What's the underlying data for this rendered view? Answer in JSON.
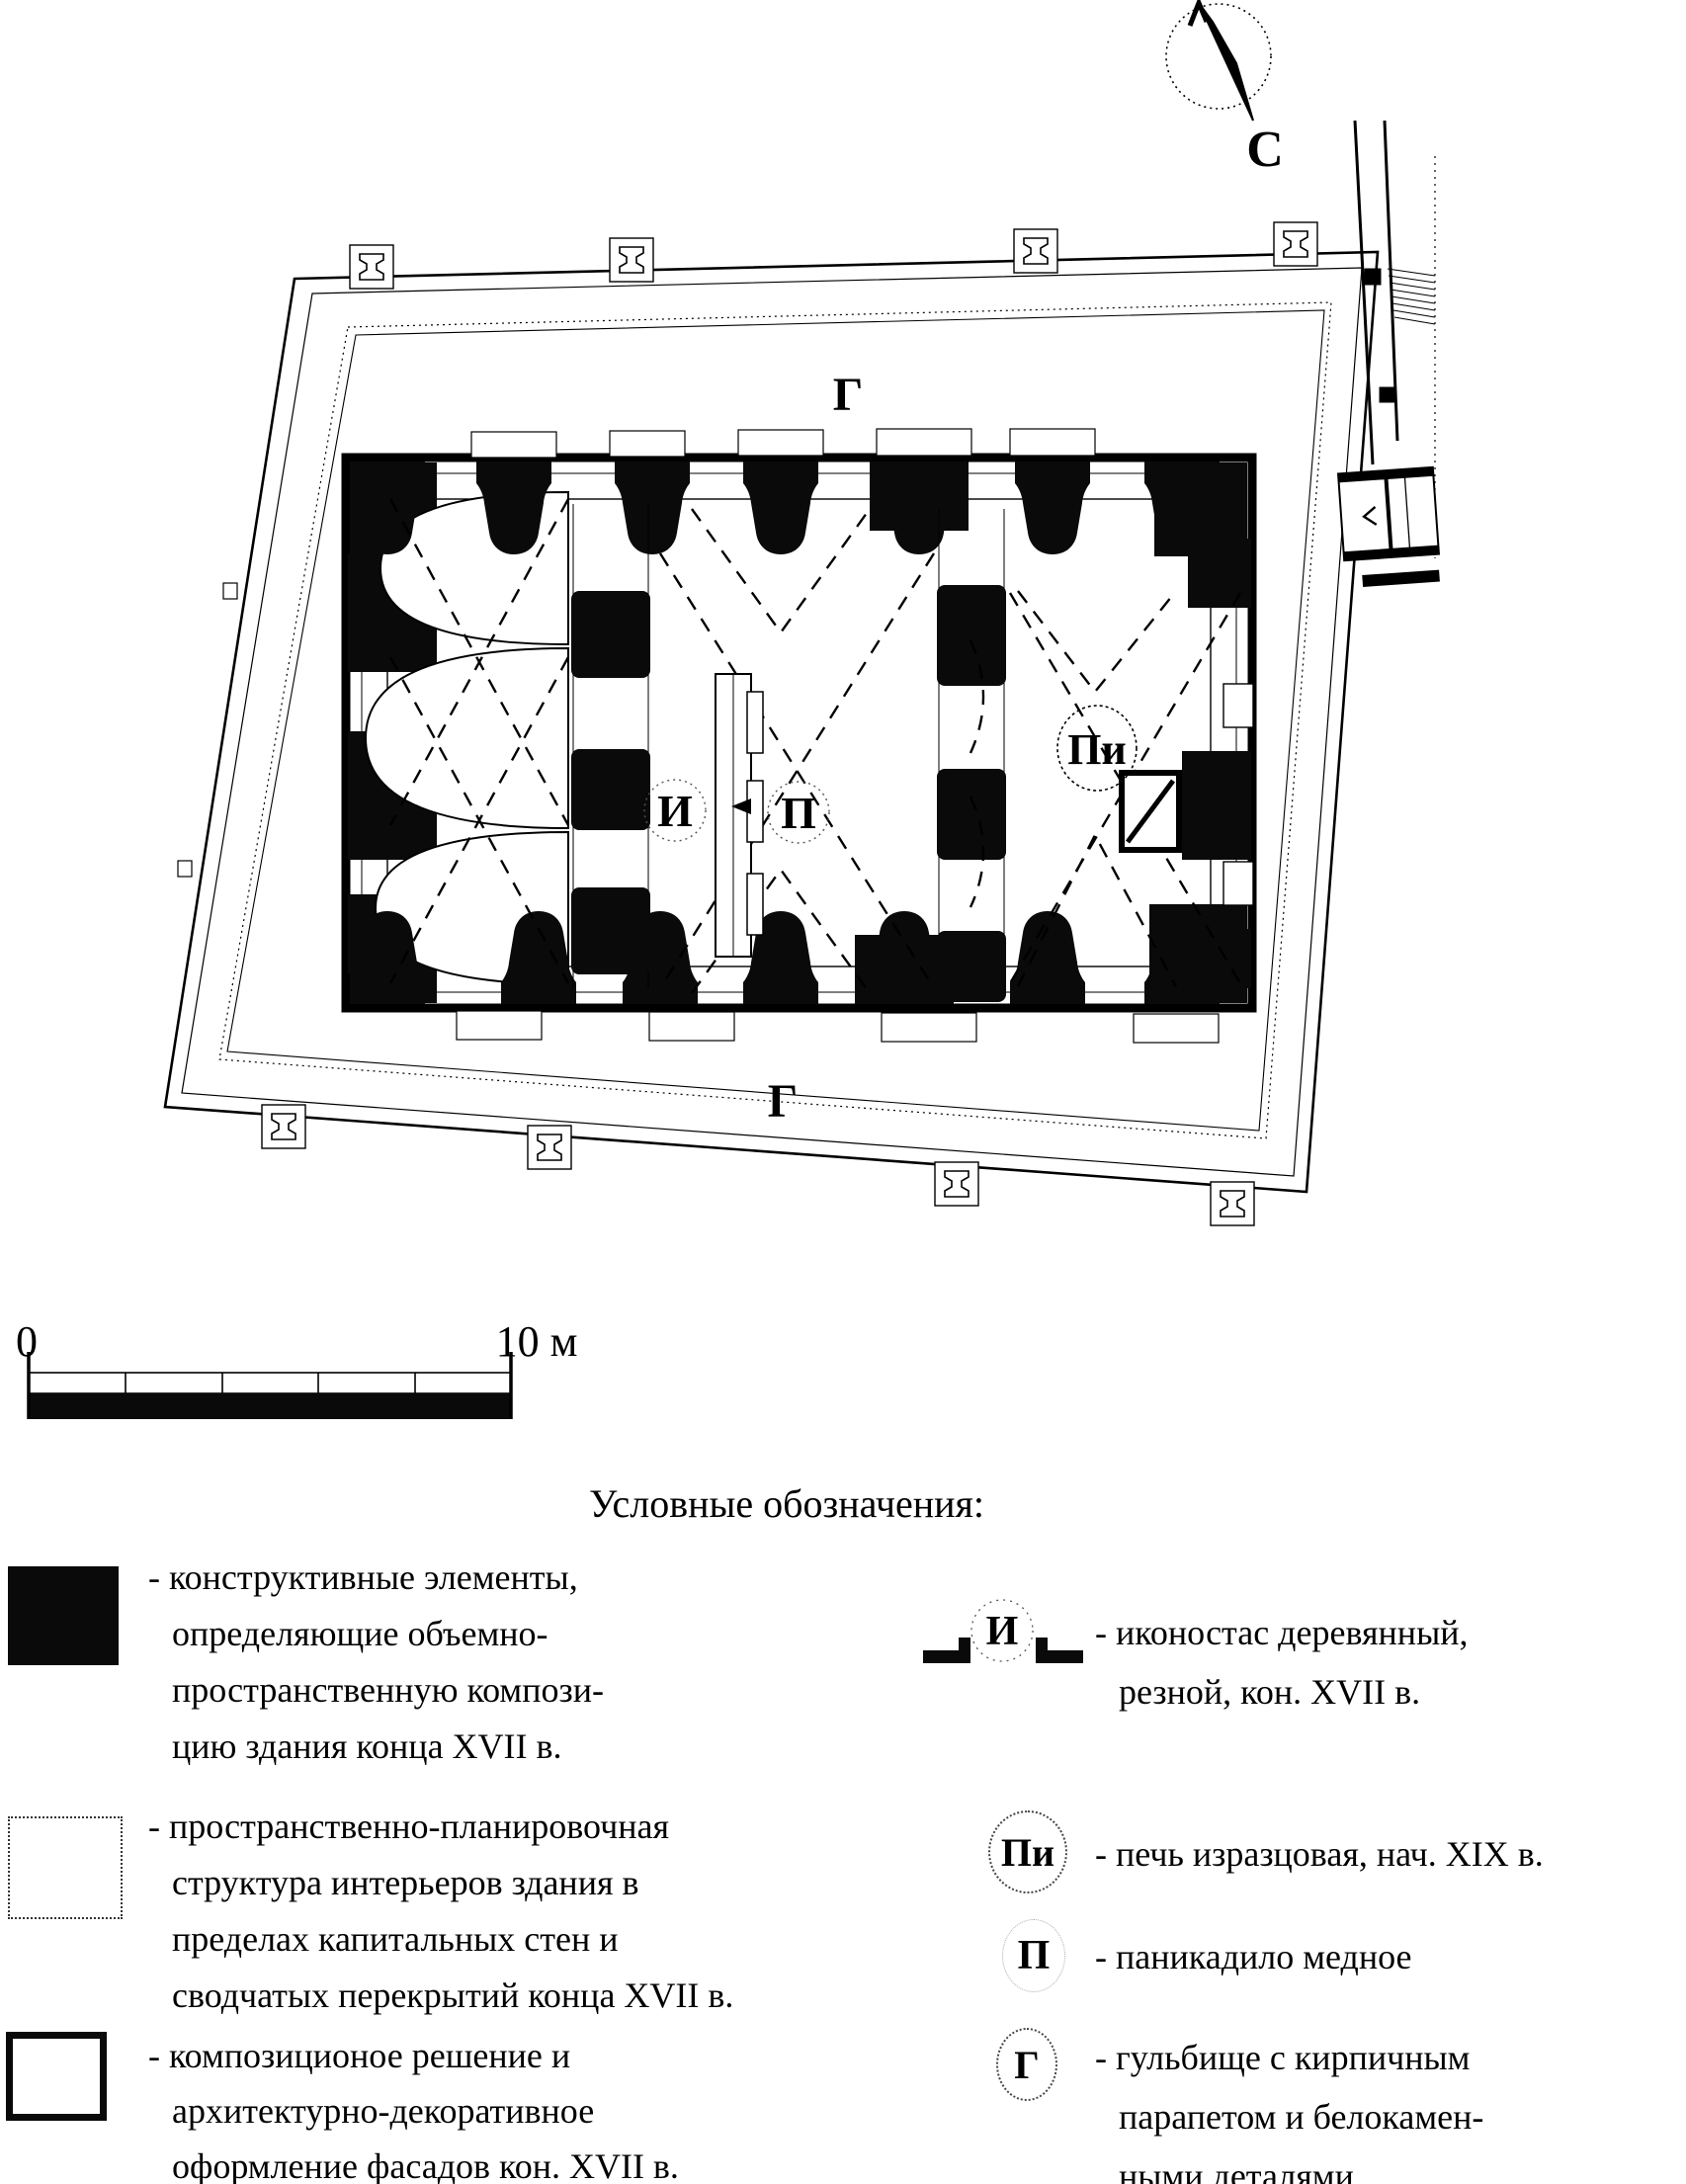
{
  "colors": {
    "ink": "#000000",
    "paper": "#ffffff"
  },
  "compass": {
    "north_label": "С"
  },
  "plan": {
    "labels": {
      "gallery_top": "Г",
      "gallery_bottom": "Г",
      "iconostasis": "И",
      "chandelier": "П",
      "stove": "Пи"
    }
  },
  "scale_bar": {
    "start_label": "0",
    "end_label": "10 м"
  },
  "legend": {
    "title": "Условные обозначения:",
    "left_items": [
      {
        "swatch": "solid-black",
        "lines": [
          "- конструктивные элементы,",
          "определяющие объемно-",
          "пространственную компози-",
          "цию здания конца XVII в."
        ]
      },
      {
        "swatch": "dotted-outline",
        "lines": [
          "- пространственно-планировочная",
          "структура интерьеров здания в",
          "пределах капитальных стен и",
          "сводчатых перекрытий конца XVII в."
        ]
      },
      {
        "swatch": "thick-outline",
        "lines": [
          "- композиционое решение и",
          "архитектурно-декоративное",
          "оформление фасадов кон. XVII в."
        ]
      }
    ],
    "right_items": [
      {
        "symbol": "И",
        "lines": [
          "- иконостас деревянный,",
          "резной, кон. XVII в."
        ]
      },
      {
        "symbol": "Пи",
        "lines": [
          "- печь изразцовая, нач. XIX в."
        ]
      },
      {
        "symbol": "П",
        "lines": [
          "- паникадило медное"
        ]
      },
      {
        "symbol": "Г",
        "lines": [
          "- гульбище с кирпичным",
          "парапетом и белокамен-",
          "ными деталями"
        ]
      }
    ]
  }
}
